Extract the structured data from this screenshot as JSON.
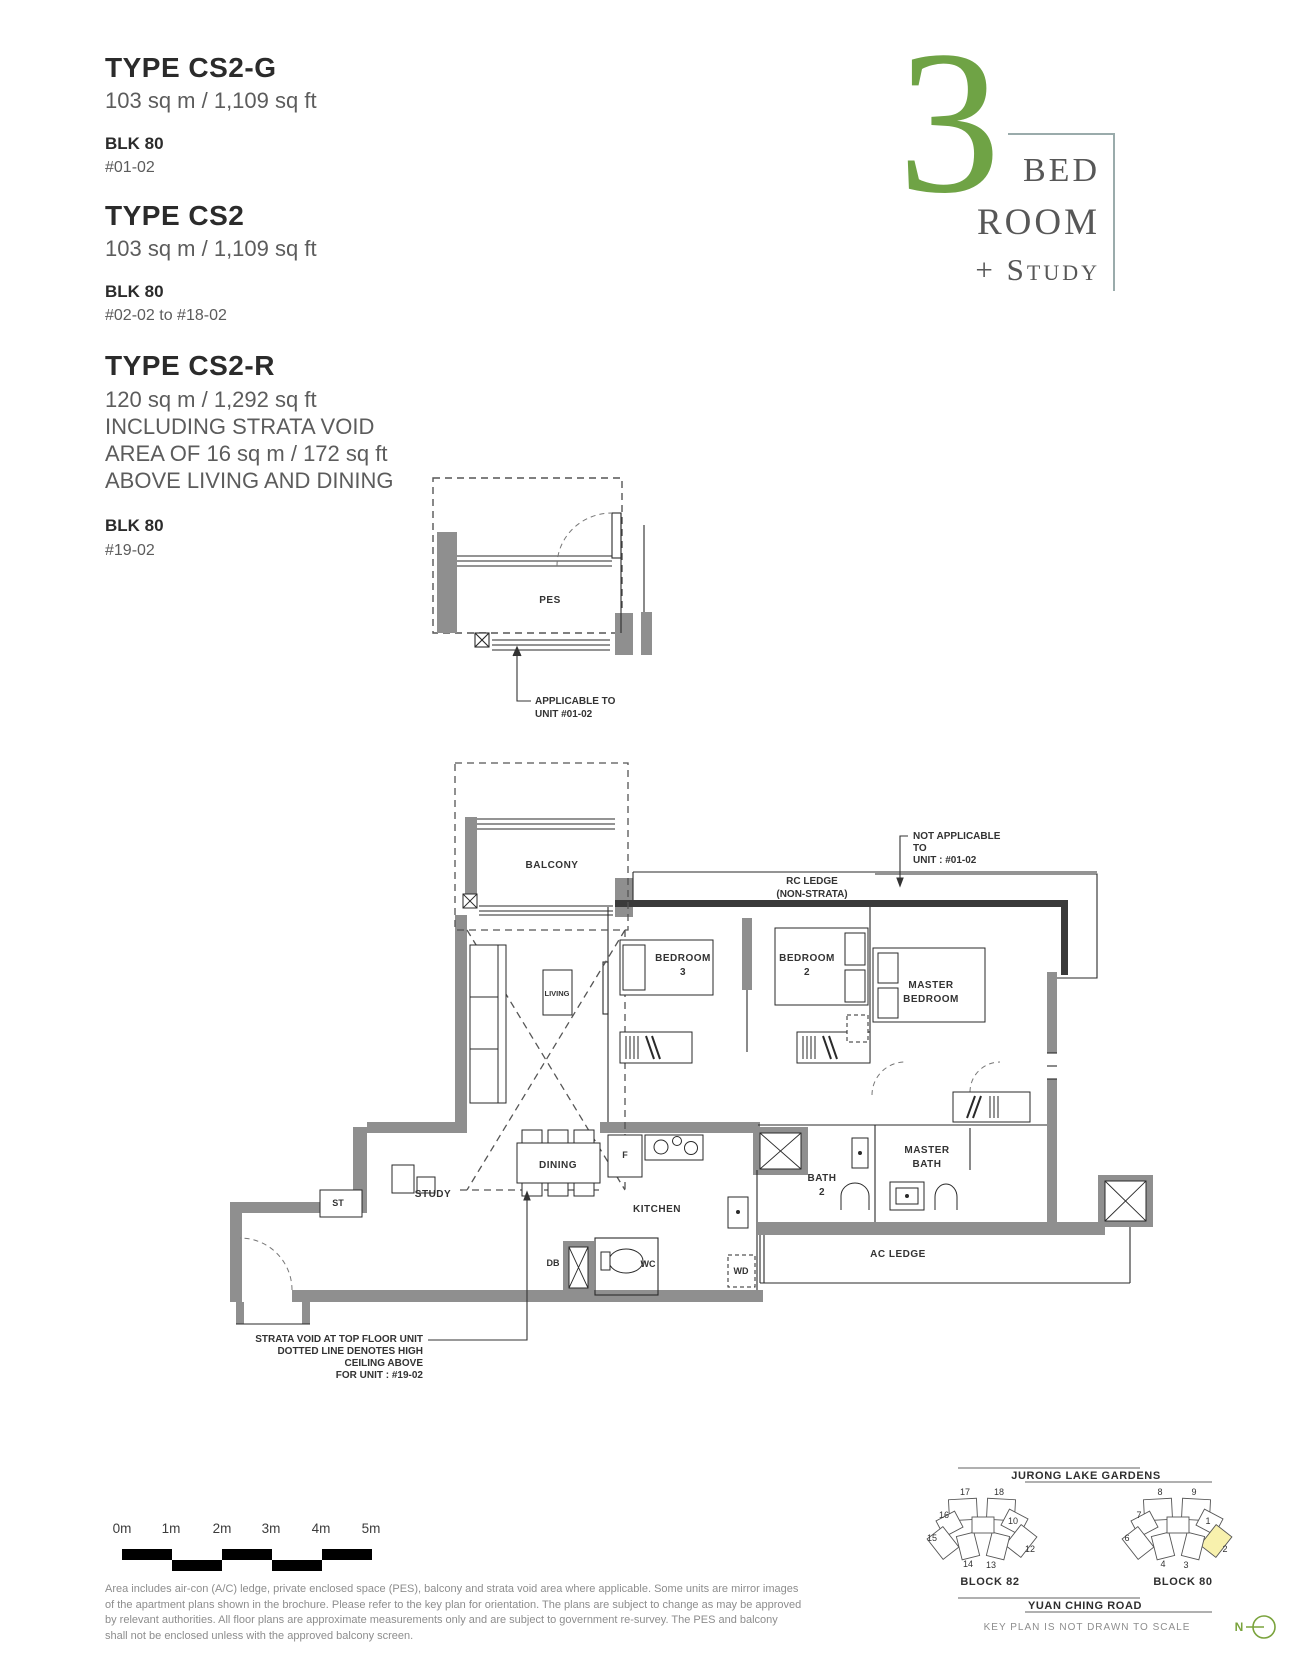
{
  "unit_types": [
    {
      "name": "TYPE CS2-G",
      "area": "103 sq m / 1,109 sq ft",
      "block": "BLK 80",
      "units": "#01-02"
    },
    {
      "name": "TYPE CS2",
      "area": "103 sq m / 1,109 sq ft",
      "block": "BLK 80",
      "units": "#02-02 to #18-02"
    },
    {
      "name": "TYPE CS2-R",
      "area": "120 sq m / 1,292 sq ft",
      "notes": [
        "INCLUDING STRATA VOID",
        "AREA OF 16 sq m / 172 sq ft",
        "ABOVE LIVING AND DINING"
      ],
      "block": "BLK 80",
      "units": "#19-02"
    }
  ],
  "logo": {
    "number": "3",
    "word1": "BED",
    "word2": "ROOM",
    "word3": "+ Study",
    "number_color": "#6fa345",
    "text_color": "#575757",
    "line_color": "#9aabab"
  },
  "pes_plan": {
    "room": "PES",
    "note": [
      "APPLICABLE TO",
      "UNIT #01-02"
    ]
  },
  "plan": {
    "rooms": {
      "balcony": "BALCONY",
      "living": "LIVING",
      "dining": "DINING",
      "study": "STUDY",
      "st": "ST",
      "kitchen": "KITCHEN",
      "fridge": "F",
      "db": "DB",
      "wc": "WC",
      "wd": "WD",
      "bedroom3": [
        "BEDROOM",
        "3"
      ],
      "bedroom2": [
        "BEDROOM",
        "2"
      ],
      "master_bedroom": [
        "MASTER",
        "BEDROOM"
      ],
      "bath2": [
        "BATH",
        "2"
      ],
      "master_bath": [
        "MASTER",
        "BATH"
      ],
      "ac_ledge": "AC LEDGE"
    },
    "annotations": {
      "rc_ledge": [
        "RC LEDGE",
        "(NON-STRATA)"
      ],
      "not_applicable": [
        "NOT APPLICABLE",
        "TO",
        "UNIT : #01-02"
      ],
      "strata_void": [
        "STRATA VOID AT TOP FLOOR UNIT",
        "DOTTED LINE DENOTES HIGH",
        "CEILING ABOVE",
        "FOR UNIT : #19-02"
      ]
    }
  },
  "scale_bar": {
    "labels": [
      "0m",
      "1m",
      "2m",
      "3m",
      "4m",
      "5m"
    ]
  },
  "disclaimer_lines": [
    "Area includes air-con (A/C) ledge, private enclosed space (PES), balcony and strata void area where applicable. Some units are mirror images",
    "of the apartment plans shown in the brochure. Please refer to the key plan for orientation. The plans are subject to change as may be approved",
    "by relevant authorities. All floor plans are approximate measurements only and are subject to government re-survey. The PES and balcony",
    "shall not be enclosed unless with the approved balcony screen."
  ],
  "key_plan": {
    "top_road": "JURONG LAKE GARDENS",
    "bottom_road": "YUAN CHING ROAD",
    "note": "KEY PLAN IS NOT DRAWN TO SCALE",
    "block82_label": "BLOCK 82",
    "block80_label": "BLOCK 80",
    "compass_n": "N",
    "highlight_color": "#f8f1ad",
    "block82_units": [
      "17",
      "18",
      "16",
      "10",
      "15",
      "12",
      "14",
      "13"
    ],
    "block80_units": [
      "8",
      "9",
      "7",
      "1",
      "6",
      "2",
      "4",
      "3"
    ],
    "highlighted_unit": "2"
  }
}
